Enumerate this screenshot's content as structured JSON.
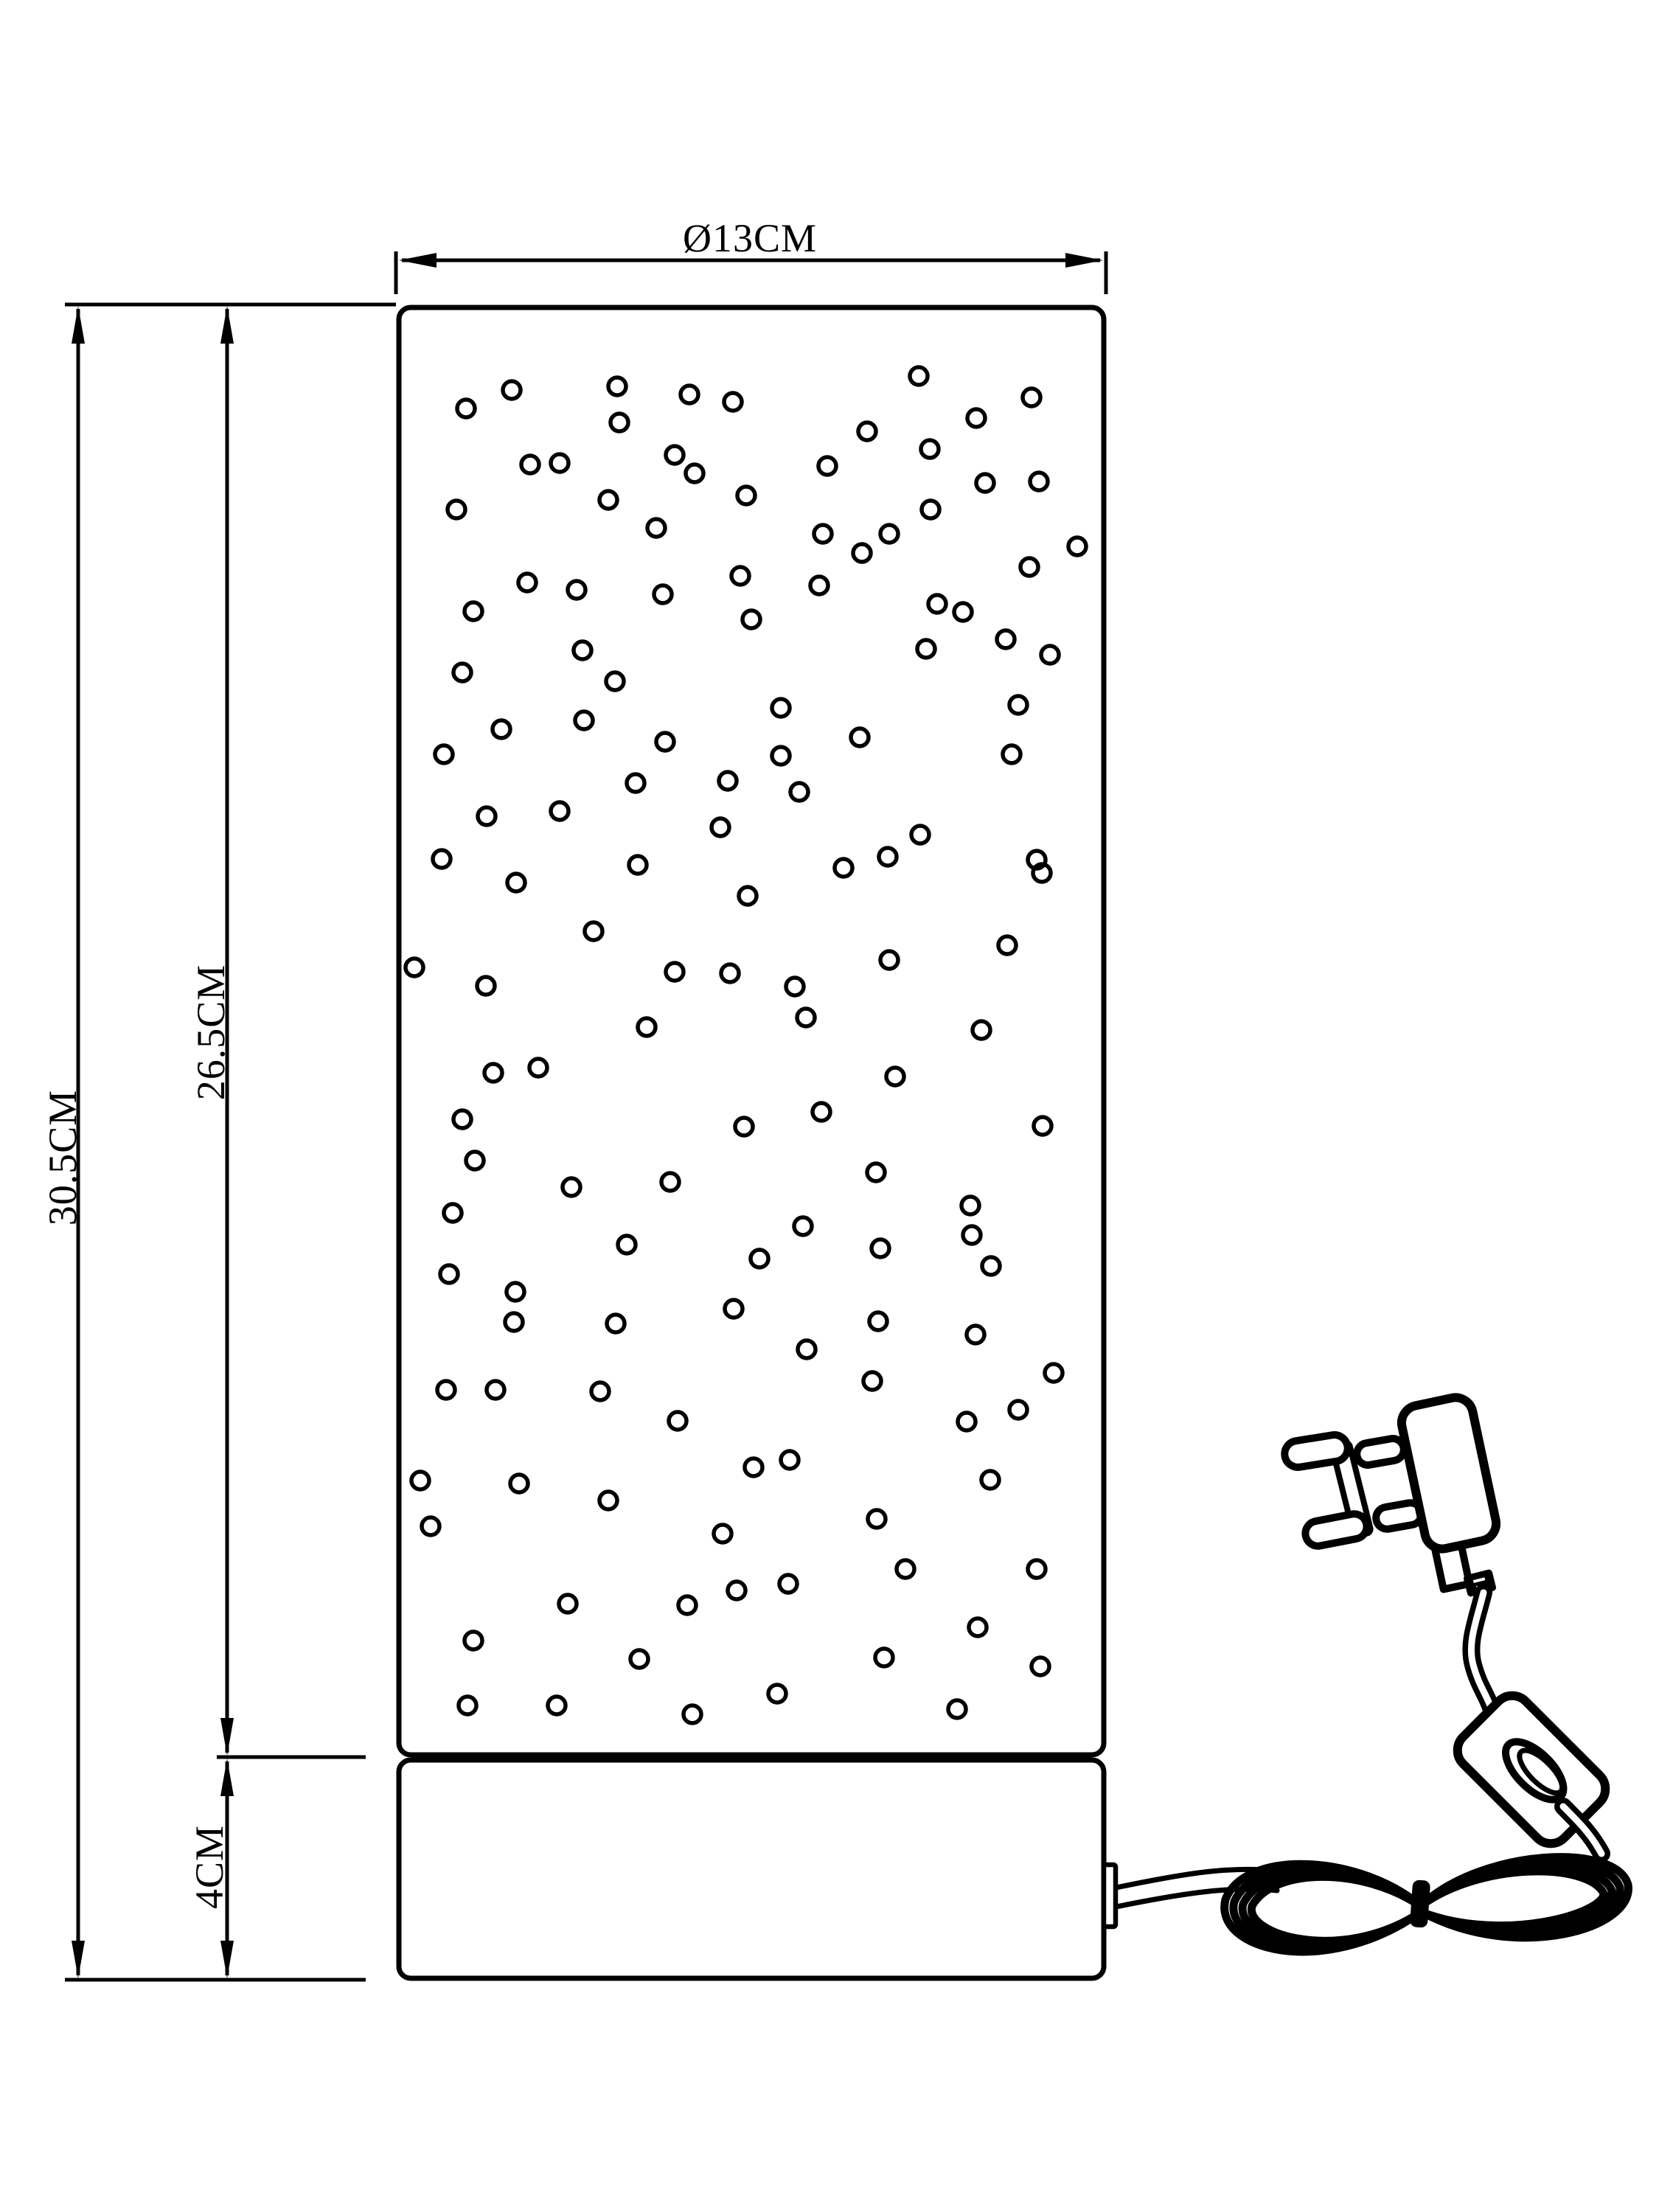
{
  "drawing": {
    "type": "technical dimension diagram of a bubble column table lamp with UK plug, inline switch and coiled cable",
    "background_color": "#ffffff",
    "line_color": "#000000"
  },
  "dimensions": {
    "width_label": "Ø13CM",
    "total_height_label": "30.5CM",
    "body_height_label": "26.5CM",
    "base_height_label": "4CM"
  },
  "bubble_style": {
    "radius": 12,
    "stroke_width": 5.5
  },
  "bubbles": [
    [
      694,
      529
    ],
    [
      632,
      554
    ],
    [
      837,
      524
    ],
    [
      935,
      535
    ],
    [
      994,
      545
    ],
    [
      840,
      573
    ],
    [
      719,
      630
    ],
    [
      759,
      628
    ],
    [
      915,
      617
    ],
    [
      942,
      642
    ],
    [
      1012,
      672
    ],
    [
      619,
      691
    ],
    [
      825,
      678
    ],
    [
      890,
      716
    ],
    [
      715,
      790
    ],
    [
      782,
      800
    ],
    [
      642,
      829
    ],
    [
      899,
      806
    ],
    [
      1004,
      781
    ],
    [
      1019,
      840
    ],
    [
      790,
      882
    ],
    [
      627,
      912
    ],
    [
      834,
      924
    ],
    [
      792,
      977
    ],
    [
      680,
      989
    ],
    [
      602,
      1023
    ],
    [
      902,
      1006
    ],
    [
      862,
      1062
    ],
    [
      987,
      1059
    ],
    [
      1246,
      510
    ],
    [
      1399,
      539
    ],
    [
      1324,
      567
    ],
    [
      1176,
      585
    ],
    [
      1261,
      609
    ],
    [
      1122,
      632
    ],
    [
      1336,
      655
    ],
    [
      1409,
      653
    ],
    [
      1262,
      691
    ],
    [
      1116,
      724
    ],
    [
      1206,
      724
    ],
    [
      1169,
      750
    ],
    [
      1461,
      741
    ],
    [
      1396,
      769
    ],
    [
      1111,
      794
    ],
    [
      1271,
      819
    ],
    [
      1306,
      830
    ],
    [
      1364,
      867
    ],
    [
      1256,
      880
    ],
    [
      1424,
      888
    ],
    [
      1059,
      960
    ],
    [
      1381,
      956
    ],
    [
      1166,
      1000
    ],
    [
      1059,
      1025
    ],
    [
      1372,
      1023
    ],
    [
      1084,
      1074
    ],
    [
      660,
      1107
    ],
    [
      759,
      1100
    ],
    [
      977,
      1122
    ],
    [
      599,
      1165
    ],
    [
      865,
      1173
    ],
    [
      700,
      1197
    ],
    [
      1014,
      1215
    ],
    [
      805,
      1263
    ],
    [
      562,
      1312
    ],
    [
      915,
      1318
    ],
    [
      990,
      1320
    ],
    [
      659,
      1337
    ],
    [
      877,
      1393
    ],
    [
      669,
      1455
    ],
    [
      730,
      1448
    ],
    [
      627,
      1518
    ],
    [
      1009,
      1528
    ],
    [
      1248,
      1132
    ],
    [
      1204,
      1162
    ],
    [
      1144,
      1177
    ],
    [
      1406,
      1166
    ],
    [
      1413,
      1184
    ],
    [
      1366,
      1282
    ],
    [
      1206,
      1302
    ],
    [
      1078,
      1338
    ],
    [
      1093,
      1380
    ],
    [
      1331,
      1397
    ],
    [
      1214,
      1460
    ],
    [
      1114,
      1508
    ],
    [
      1414,
      1527
    ],
    [
      1188,
      1590
    ],
    [
      644,
      1574
    ],
    [
      775,
      1610
    ],
    [
      909,
      1603
    ],
    [
      614,
      1645
    ],
    [
      850,
      1688
    ],
    [
      1030,
      1707
    ],
    [
      609,
      1728
    ],
    [
      699,
      1752
    ],
    [
      697,
      1793
    ],
    [
      835,
      1795
    ],
    [
      995,
      1775
    ],
    [
      605,
      1885
    ],
    [
      672,
      1885
    ],
    [
      814,
      1887
    ],
    [
      919,
      1927
    ],
    [
      1022,
      1990
    ],
    [
      570,
      2008
    ],
    [
      704,
      2012
    ],
    [
      825,
      2035
    ],
    [
      1316,
      1635
    ],
    [
      1089,
      1663
    ],
    [
      1318,
      1675
    ],
    [
      1194,
      1693
    ],
    [
      1344,
      1717
    ],
    [
      1191,
      1792
    ],
    [
      1323,
      1810
    ],
    [
      1094,
      1830
    ],
    [
      1183,
      1873
    ],
    [
      1429,
      1862
    ],
    [
      1381,
      1912
    ],
    [
      1311,
      1928
    ],
    [
      1071,
      1980
    ],
    [
      1343,
      2007
    ],
    [
      1189,
      2060
    ],
    [
      584,
      2070
    ],
    [
      980,
      2080
    ],
    [
      770,
      2175
    ],
    [
      932,
      2177
    ],
    [
      999,
      2157
    ],
    [
      642,
      2225
    ],
    [
      867,
      2250
    ],
    [
      634,
      2313
    ],
    [
      755,
      2313
    ],
    [
      939,
      2325
    ],
    [
      1069,
      2148
    ],
    [
      1228,
      2128
    ],
    [
      1406,
      2128
    ],
    [
      1326,
      2207
    ],
    [
      1199,
      2248
    ],
    [
      1411,
      2260
    ],
    [
      1054,
      2297
    ],
    [
      1298,
      2318
    ]
  ]
}
